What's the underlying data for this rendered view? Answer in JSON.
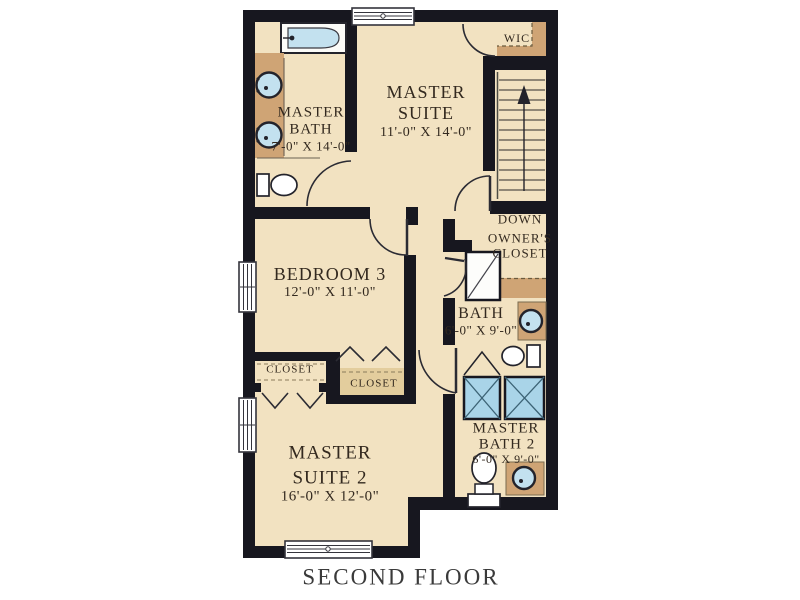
{
  "floor_title": "SECOND FLOOR",
  "rooms": {
    "master_suite": {
      "name1": "MASTER",
      "name2": "SUITE",
      "dims": "11'-0\" X 14'-0\""
    },
    "master_bath": {
      "name1": "MASTER",
      "name2": "BATH",
      "dims": "7'-0\" X 14'-0\""
    },
    "bedroom3": {
      "name": "BEDROOM 3",
      "dims": "12'-0\" X 11'-0\""
    },
    "bath": {
      "name": "BATH",
      "dims": "6'-0\" X 9'-0\""
    },
    "master_suite2": {
      "name1": "MASTER",
      "name2": "SUITE 2",
      "dims": "16'-0\" X 12'-0\""
    },
    "master_bath2": {
      "name1": "MASTER",
      "name2": "BATH 2",
      "dims": "6'-0\" X 9'-0\""
    },
    "wic": {
      "name": "WIC"
    },
    "owners_closet": {
      "name1": "OWNER'S",
      "name2": "CLOSET"
    },
    "closet_left": {
      "name": "CLOSET"
    },
    "closet_right": {
      "name": "CLOSET"
    }
  },
  "stairs": {
    "label": "DOWN"
  },
  "colors": {
    "wall": "#17171f",
    "floor": "#f2e2c1",
    "counter": "#cfa475",
    "fixture_blue": "#c3e1ef",
    "shower_unit_blue": "#a9d4e8",
    "label_text": "#33291f",
    "title_text": "#3a3a3a",
    "background": "#ffffff"
  }
}
